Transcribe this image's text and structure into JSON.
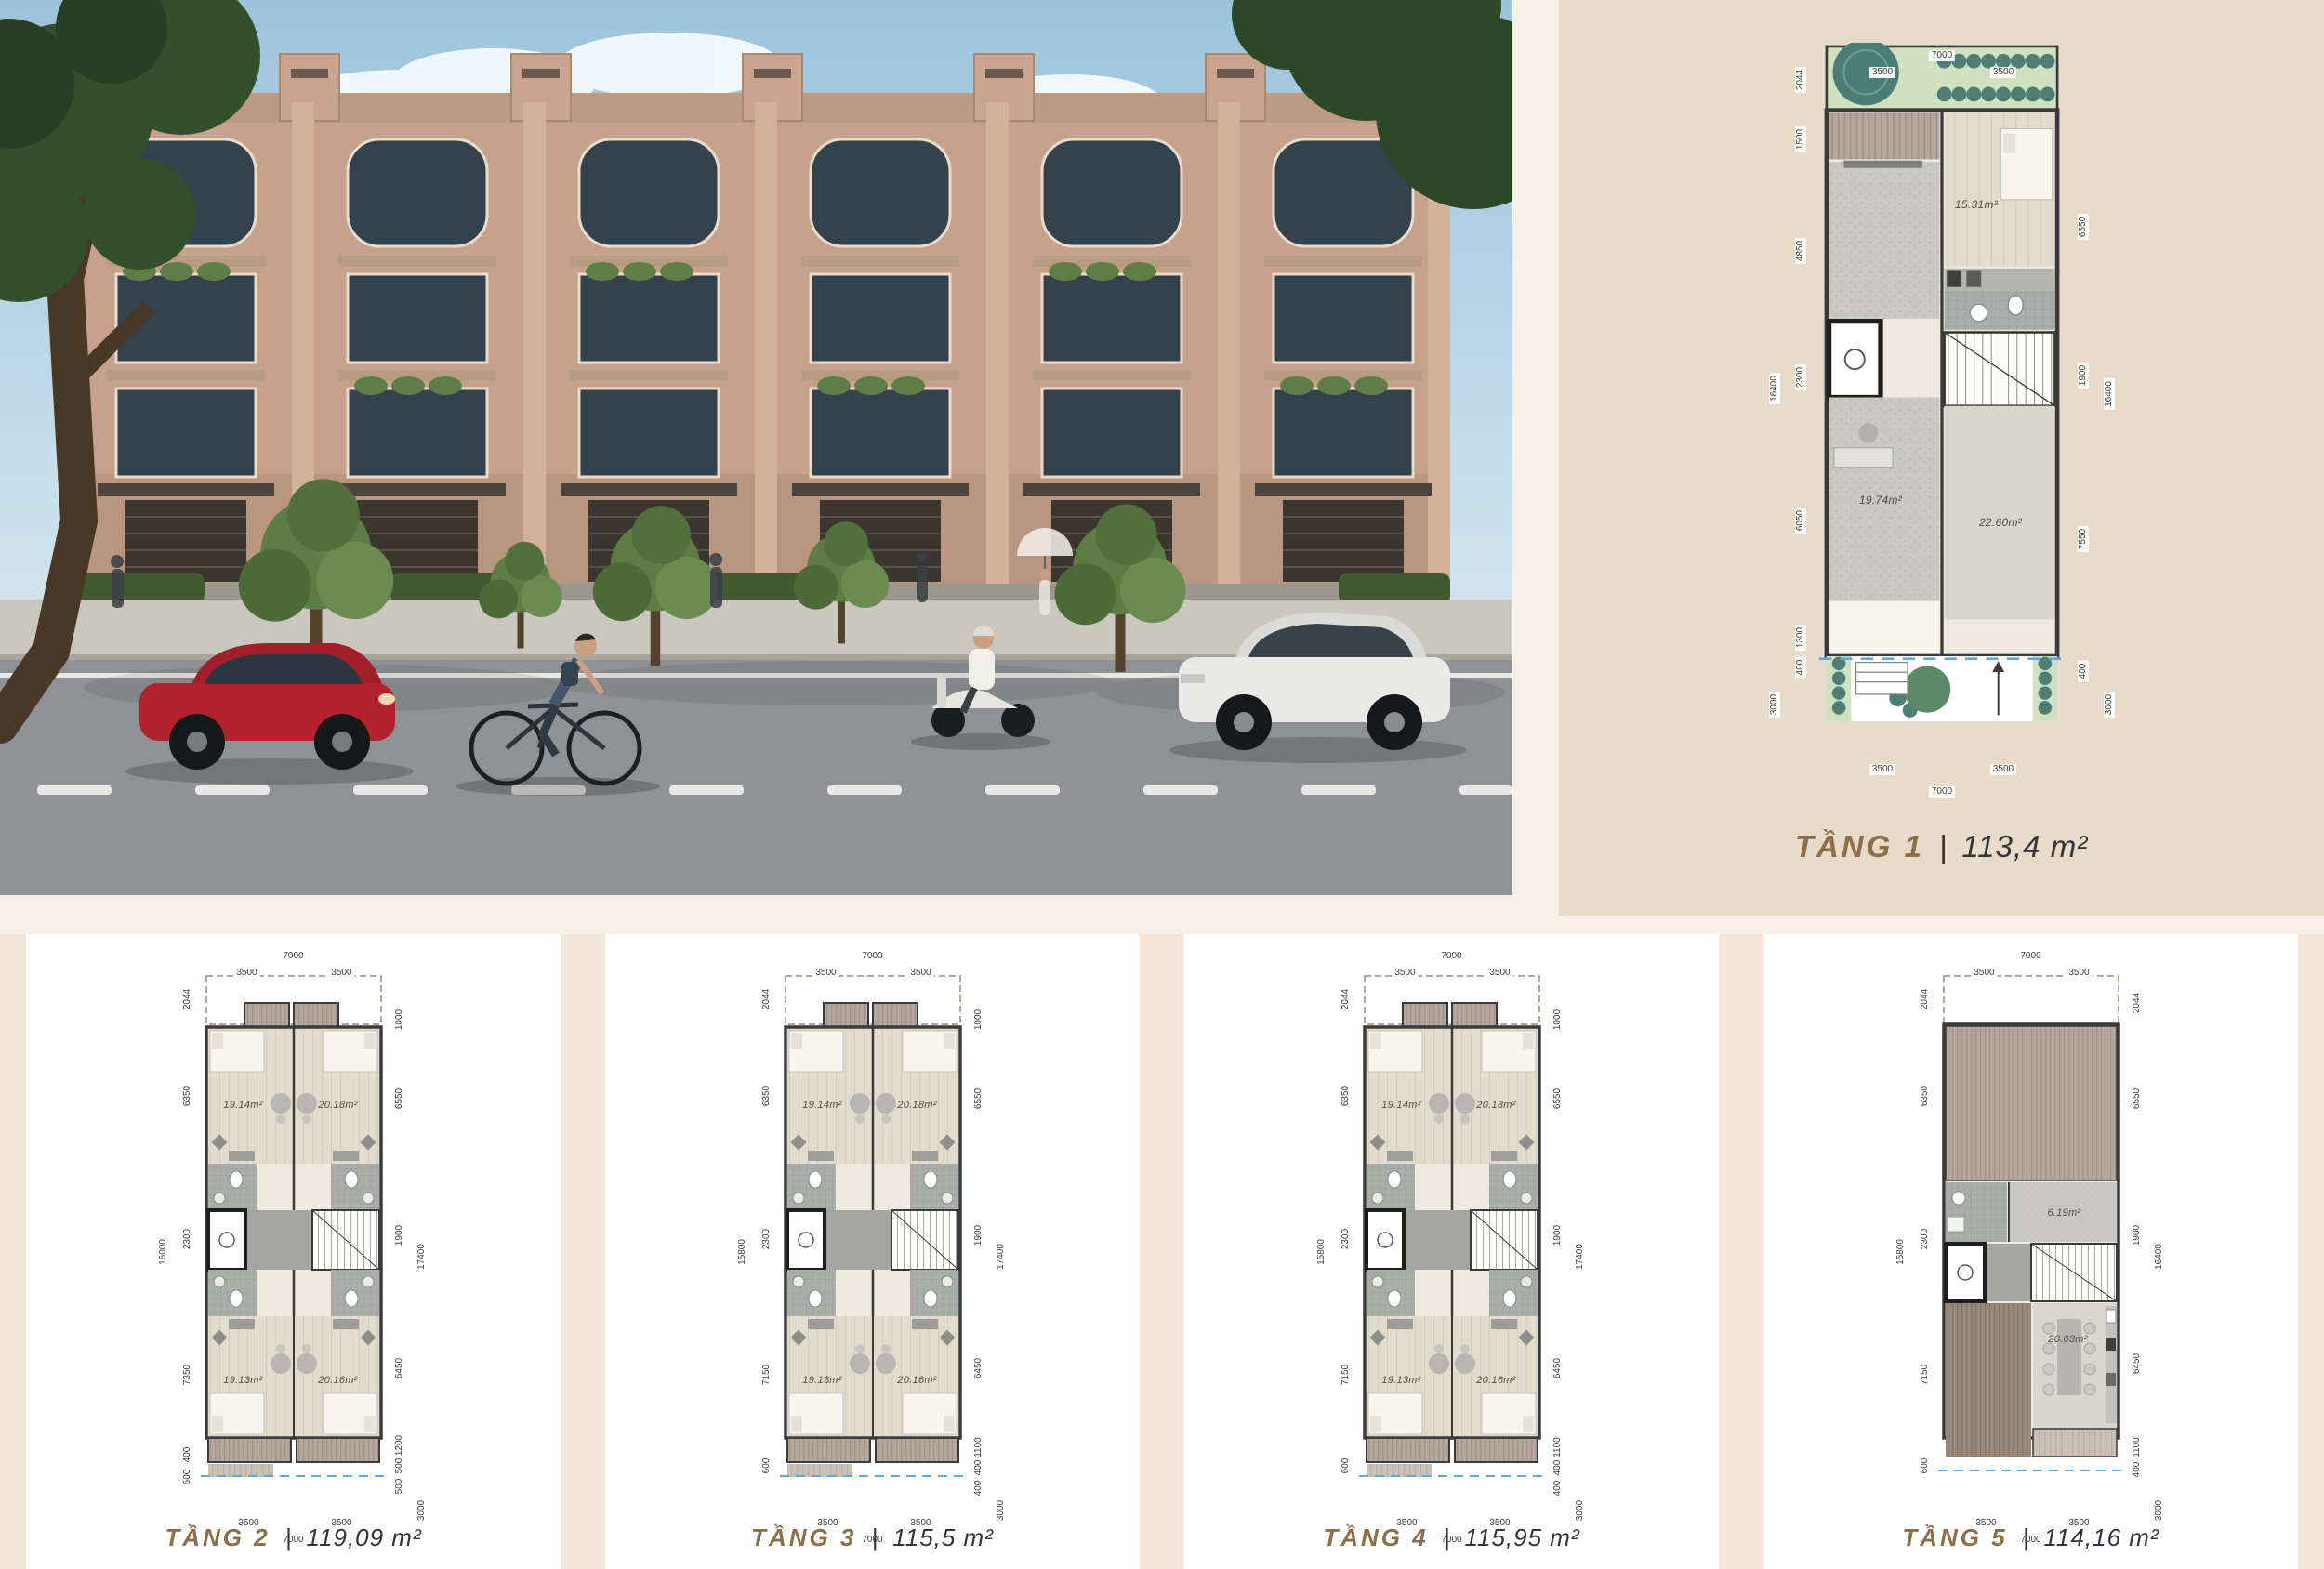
{
  "separator": "|",
  "colors": {
    "accent_brown": "#8d6e49",
    "title_dark": "#33343a",
    "panel_cream": "#e8dbc9",
    "card_white": "#ffffff",
    "section_pink": "#f4e7da",
    "page_band": "#f8efe8",
    "dashed_blue": "#5fa8d8",
    "garden_green": "#cfe1c0",
    "shrub_teal": "#4e7e76"
  },
  "photo": {
    "objects": [
      "townhouse-row",
      "street",
      "sidewalk",
      "trees",
      "red-car",
      "white-car",
      "cyclist",
      "scooter-rider",
      "pedestrians"
    ]
  },
  "plans": [
    {
      "floor_label": "TẦNG 1",
      "area_label": "113,4 m²",
      "rooms": [
        "15.31m²",
        "19.74m²",
        "22.60m²"
      ],
      "dims_top": [
        "7000",
        "3500",
        "3500"
      ],
      "dims_left": [
        "2044",
        "1500",
        "4850",
        "16400",
        "2300",
        "6050",
        "1300",
        "400",
        "3000"
      ],
      "dims_right": [
        "6550",
        "1900",
        "16400",
        "7550",
        "400",
        "3000"
      ],
      "dims_bottom": [
        "3500",
        "3500",
        "7000"
      ]
    },
    {
      "floor_label": "TẦNG 2",
      "area_label": "119,09 m²",
      "rooms": [
        "19.14m²",
        "20.18m²",
        "19.13m²",
        "20.16m²"
      ],
      "dims_top": [
        "7000",
        "3500",
        "3500"
      ],
      "dims_left": [
        "2044",
        "6350",
        "16000",
        "2300",
        "7350",
        "400",
        "500"
      ],
      "dims_right": [
        "1000",
        "6550",
        "1900",
        "17400",
        "6450",
        "1200",
        "500",
        "500",
        "3000"
      ],
      "dims_bottom": [
        "3500",
        "3500",
        "7000"
      ]
    },
    {
      "floor_label": "TẦNG 3",
      "area_label": "115,5 m²",
      "rooms": [
        "19.14m²",
        "20.18m²",
        "19.13m²",
        "20.16m²"
      ],
      "dims_top": [
        "7000",
        "3500",
        "3500"
      ],
      "dims_left": [
        "2044",
        "6350",
        "15800",
        "2300",
        "7150",
        "600"
      ],
      "dims_right": [
        "1000",
        "6550",
        "1900",
        "17400",
        "6450",
        "1100",
        "400",
        "400",
        "3000"
      ],
      "dims_bottom": [
        "3500",
        "3500",
        "7000"
      ]
    },
    {
      "floor_label": "TẦNG 4",
      "area_label": "115,95 m²",
      "rooms": [
        "19.14m²",
        "20.18m²",
        "19.13m²",
        "20.16m²"
      ],
      "dims_top": [
        "7000",
        "3500",
        "3500"
      ],
      "dims_left": [
        "2044",
        "6350",
        "15800",
        "2300",
        "7150",
        "600"
      ],
      "dims_right": [
        "1000",
        "6550",
        "1900",
        "17400",
        "6450",
        "1100",
        "400",
        "400",
        "3000"
      ],
      "dims_bottom": [
        "3500",
        "3500",
        "7000"
      ]
    },
    {
      "floor_label": "TẦNG 5",
      "area_label": "114,16 m²",
      "rooms": [
        "6.19m²",
        "20.03m²"
      ],
      "dims_top": [
        "7000",
        "3500",
        "3500"
      ],
      "dims_left": [
        "2044",
        "6350",
        "15800",
        "2300",
        "7150",
        "600"
      ],
      "dims_right": [
        "2044",
        "6550",
        "1900",
        "16400",
        "6450",
        "1100",
        "400",
        "3000"
      ],
      "dims_bottom": [
        "3500",
        "3500",
        "7000"
      ]
    }
  ]
}
